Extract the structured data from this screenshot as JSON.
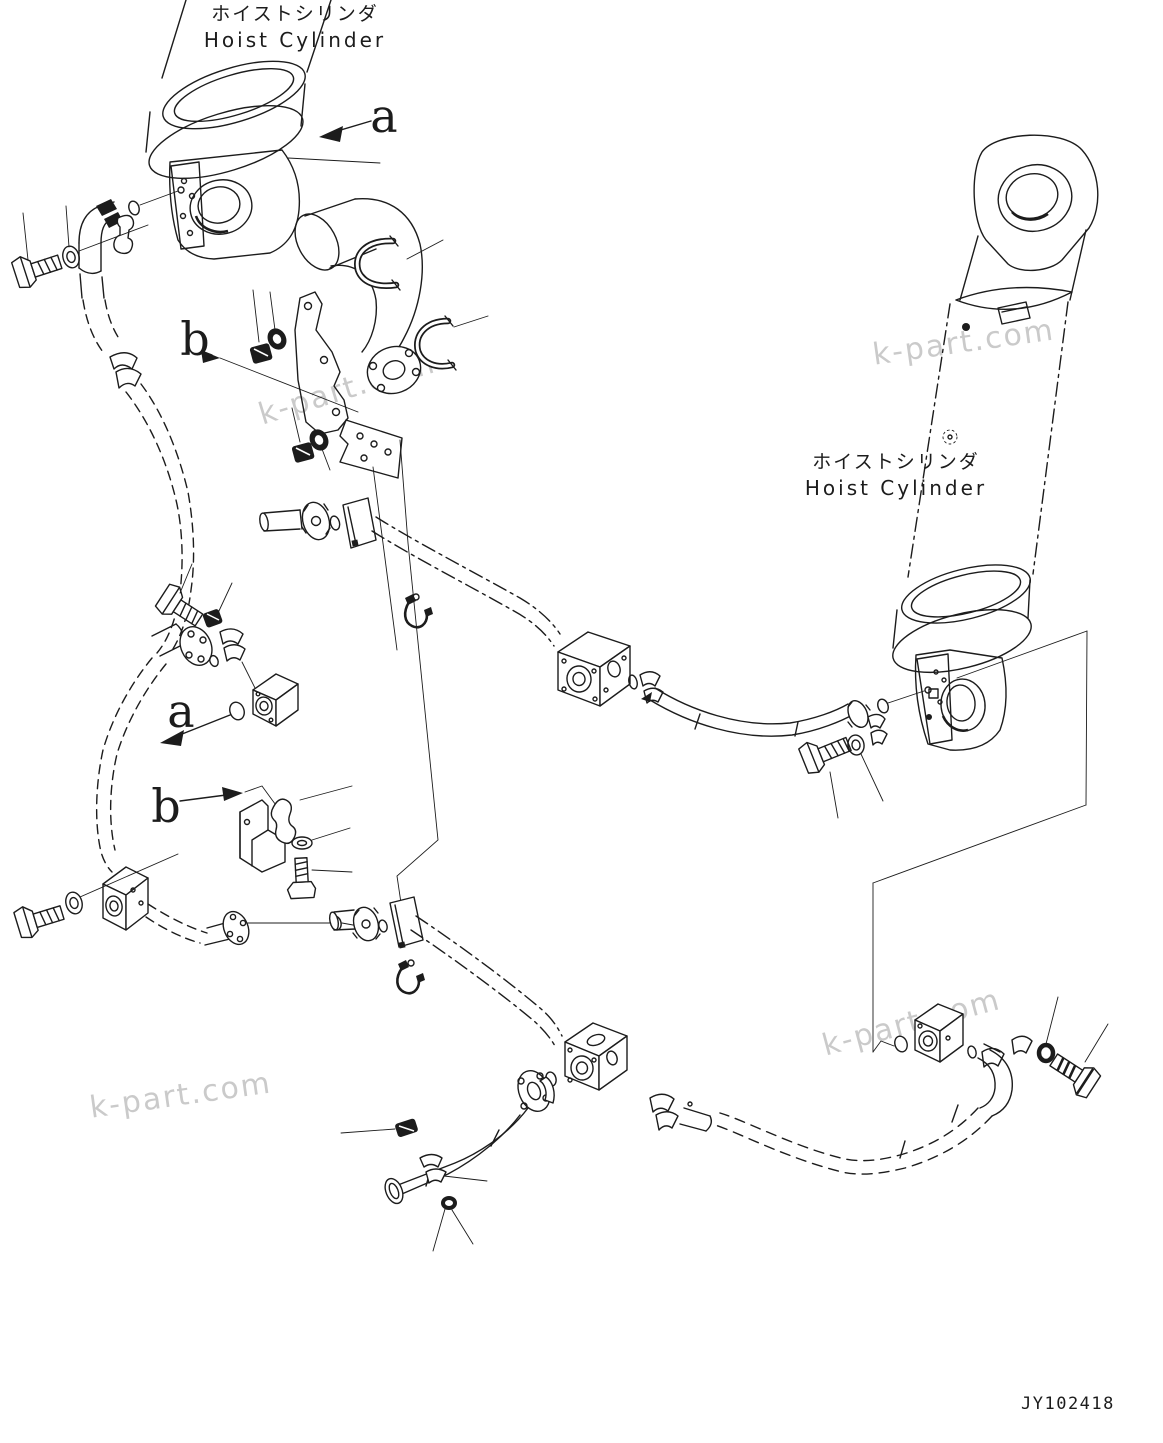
{
  "diagram": {
    "labels": {
      "left_cylinder_jp": "ホイストシリンダ",
      "left_cylinder_en": "Hoist Cylinder",
      "right_cylinder_jp": "ホイストシリンダ",
      "right_cylinder_en": "Hoist Cylinder"
    },
    "view_markers": {
      "a_upper": "a",
      "b_upper": "b",
      "a_lower": "a",
      "b_lower": "b"
    },
    "watermark": "k-part.com",
    "drawing_number": "JY102418",
    "colors": {
      "line": "#1c1c1c",
      "watermark": "#ababab",
      "background": "#ffffff"
    }
  }
}
